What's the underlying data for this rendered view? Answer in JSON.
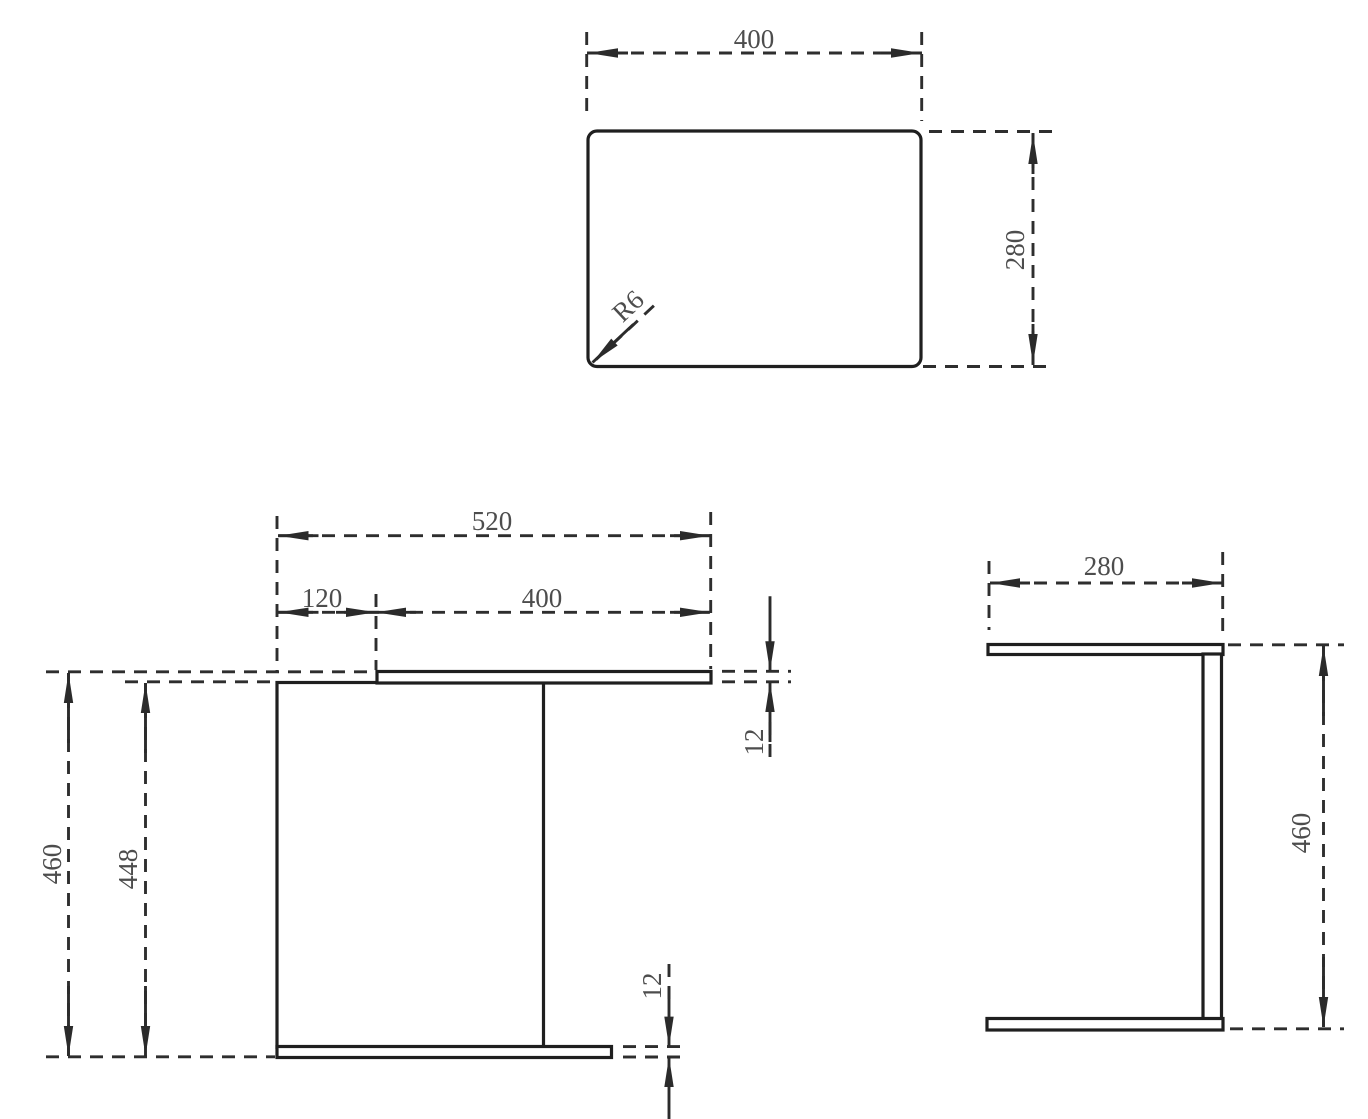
{
  "drawing": {
    "kind": "furniture-dimension-drawing",
    "canvas": {
      "width": 1368,
      "height": 1119,
      "background": "#ffffff"
    },
    "colors": {
      "outline": "#1f1f1f",
      "dash_line": "#2e2e2e",
      "arrow": "#2b2b2b",
      "label_text": "#4d4d4d"
    },
    "style": {
      "outline_width": 3.2,
      "dash_width": 2.9,
      "dash_pattern": "13 9",
      "font_size": 27,
      "arrow_length": 30,
      "arrow_half_width": 4.7,
      "default_tail": 10
    },
    "views": [
      {
        "name": "top-view",
        "primitives": [
          {
            "t": "rect",
            "n": "tabletop-outline",
            "x": 588,
            "y": 131,
            "w": 333,
            "h": 235.5,
            "r": 9
          },
          {
            "t": "line",
            "n": "width-ext-line-left",
            "x1": 586.7,
            "y1": 32,
            "x2": 586.7,
            "y2": 118,
            "dash": true
          },
          {
            "t": "line",
            "n": "width-ext-line-right",
            "x1": 921.7,
            "y1": 32,
            "x2": 921.7,
            "y2": 121,
            "dash": true
          },
          {
            "t": "line",
            "n": "width-dim-line",
            "x1": 587,
            "y1": 53,
            "x2": 922,
            "y2": 53,
            "dash": true
          },
          {
            "t": "arrow",
            "n": "width-arrow-left",
            "x": 588,
            "y": 53,
            "a": 180
          },
          {
            "t": "arrow",
            "n": "width-arrow-right",
            "x": 921,
            "y": 53,
            "a": 0
          },
          {
            "t": "text",
            "n": "width-label",
            "x": 754,
            "y": 39,
            "s": "400",
            "r": 0
          },
          {
            "t": "line",
            "n": "depth-ext-line-top",
            "x1": 929,
            "y1": 131.5,
            "x2": 1052,
            "y2": 131.5,
            "dash": true
          },
          {
            "t": "line",
            "n": "depth-ext-line-bottom",
            "x1": 923,
            "y1": 366.5,
            "x2": 1053,
            "y2": 366.5,
            "dash": true
          },
          {
            "t": "line",
            "n": "depth-dim-line",
            "x1": 1033,
            "y1": 133,
            "x2": 1033,
            "y2": 365,
            "dash": true
          },
          {
            "t": "arrow",
            "n": "depth-arrow-top",
            "x": 1033,
            "y": 134,
            "a": 270
          },
          {
            "t": "arrow",
            "n": "depth-arrow-bottom",
            "x": 1033,
            "y": 364,
            "a": 90
          },
          {
            "t": "text",
            "n": "depth-label",
            "x": 1015,
            "y": 250,
            "s": "280",
            "r": -90
          },
          {
            "t": "line",
            "n": "corner-radius-leader",
            "x1": 596,
            "y1": 359.5,
            "x2": 659,
            "y2": 301,
            "dash": true
          },
          {
            "t": "arrow",
            "n": "corner-radius-arrow",
            "x": 592.5,
            "y": 362.5,
            "a": 137,
            "tail": 26
          },
          {
            "t": "text",
            "n": "corner-radius-label",
            "x": 628,
            "y": 306,
            "s": "R6",
            "r": -43
          }
        ]
      },
      {
        "name": "front-view",
        "primitives": [
          {
            "t": "rect",
            "n": "side-panel-outline",
            "x": 277,
            "y": 682.5,
            "w": 266.5,
            "h": 365,
            "r": 0
          },
          {
            "t": "rect",
            "n": "top-plate-outline",
            "x": 377,
            "y": 671.5,
            "w": 334,
            "h": 11.5,
            "r": 0
          },
          {
            "t": "rect",
            "n": "bottom-plate-outline",
            "x": 277,
            "y": 1046.5,
            "w": 334.5,
            "h": 11,
            "r": 0
          },
          {
            "t": "line",
            "n": "total-width-ext-left",
            "x1": 277,
            "y1": 516,
            "x2": 277,
            "y2": 671,
            "dash": true
          },
          {
            "t": "line",
            "n": "total-width-ext-right",
            "x1": 710.7,
            "y1": 512,
            "x2": 710.7,
            "y2": 669,
            "dash": true
          },
          {
            "t": "line",
            "n": "total-width-dim-line",
            "x1": 278,
            "y1": 535.7,
            "x2": 710,
            "y2": 535.7,
            "dash": true
          },
          {
            "t": "arrow",
            "n": "total-width-arrow-left",
            "x": 278.5,
            "y": 535.7,
            "a": 180
          },
          {
            "t": "arrow",
            "n": "total-width-arrow-right",
            "x": 710,
            "y": 535.7,
            "a": 0
          },
          {
            "t": "text",
            "n": "total-width-label",
            "x": 492,
            "y": 521,
            "s": "520",
            "r": 0
          },
          {
            "t": "line",
            "n": "offset-ext-middle",
            "x1": 376,
            "y1": 594,
            "x2": 376,
            "y2": 670,
            "dash": true
          },
          {
            "t": "line",
            "n": "offset-topwidth-dim-line",
            "x1": 278,
            "y1": 612.3,
            "x2": 710,
            "y2": 612.3,
            "dash": true
          },
          {
            "t": "arrow",
            "n": "offset-arrow-left",
            "x": 278.5,
            "y": 612.3,
            "a": 180
          },
          {
            "t": "arrow",
            "n": "offset-arrow-right",
            "x": 376,
            "y": 612.3,
            "a": 0
          },
          {
            "t": "arrow",
            "n": "topwidth-arrow-left",
            "x": 376,
            "y": 612.3,
            "a": 180
          },
          {
            "t": "arrow",
            "n": "topwidth-arrow-right",
            "x": 710,
            "y": 612.3,
            "a": 0
          },
          {
            "t": "text",
            "n": "offset-label",
            "x": 322,
            "y": 598,
            "s": "120",
            "r": 0
          },
          {
            "t": "text",
            "n": "topwidth-label",
            "x": 542,
            "y": 598,
            "s": "400",
            "r": 0
          },
          {
            "t": "line",
            "n": "height-ext-top",
            "x1": 46,
            "y1": 671.8,
            "x2": 374,
            "y2": 671.8,
            "dash": true
          },
          {
            "t": "line",
            "n": "height-ext-bottom",
            "x1": 46,
            "y1": 1056.8,
            "x2": 275,
            "y2": 1056.8,
            "dash": true
          },
          {
            "t": "line",
            "n": "height-dim-line",
            "x1": 68.5,
            "y1": 673,
            "x2": 68.5,
            "y2": 1056,
            "dash": true
          },
          {
            "t": "arrow",
            "n": "height-arrow-top",
            "x": 68.5,
            "y": 673,
            "a": 270,
            "tail": 40
          },
          {
            "t": "arrow",
            "n": "height-arrow-bottom",
            "x": 68.5,
            "y": 1056,
            "a": 90,
            "tail": 40
          },
          {
            "t": "text",
            "n": "height-label",
            "x": 52,
            "y": 864,
            "s": "460",
            "r": -90
          },
          {
            "t": "line",
            "n": "inner-height-ext-top",
            "x1": 125,
            "y1": 681.8,
            "x2": 275,
            "y2": 681.8,
            "dash": true
          },
          {
            "t": "line",
            "n": "inner-height-dim-line",
            "x1": 145.5,
            "y1": 683,
            "x2": 145.5,
            "y2": 1056,
            "dash": true
          },
          {
            "t": "arrow",
            "n": "inner-height-arrow-top",
            "x": 145.5,
            "y": 683,
            "a": 270,
            "tail": 40
          },
          {
            "t": "arrow",
            "n": "inner-height-arrow-bottom",
            "x": 145.5,
            "y": 1056,
            "a": 90,
            "tail": 40
          },
          {
            "t": "text",
            "n": "inner-height-label",
            "x": 128,
            "y": 869,
            "s": "448",
            "r": -90
          },
          {
            "t": "line",
            "n": "top-thickness-ext-upper",
            "x1": 722,
            "y1": 671.3,
            "x2": 791,
            "y2": 671.3,
            "dash": true
          },
          {
            "t": "line",
            "n": "top-thickness-ext-lower",
            "x1": 722,
            "y1": 681.8,
            "x2": 791,
            "y2": 681.8,
            "dash": true
          },
          {
            "t": "arrow",
            "n": "top-thickness-arrow-down",
            "x": 770,
            "y": 671.3,
            "a": 90,
            "tail": 45
          },
          {
            "t": "arrow",
            "n": "top-thickness-arrow-up",
            "x": 770,
            "y": 682,
            "a": 270,
            "tail": 30
          },
          {
            "t": "line",
            "n": "top-thickness-leader",
            "x1": 770,
            "y1": 722,
            "x2": 770,
            "y2": 764,
            "dash": true
          },
          {
            "t": "text",
            "n": "top-thickness-label",
            "x": 754,
            "y": 742,
            "s": "12",
            "r": -90
          },
          {
            "t": "line",
            "n": "bottom-thickness-ext-upper",
            "x1": 623,
            "y1": 1046.6,
            "x2": 688,
            "y2": 1046.6,
            "dash": true
          },
          {
            "t": "line",
            "n": "bottom-thickness-ext-lower",
            "x1": 623,
            "y1": 1057,
            "x2": 688,
            "y2": 1057,
            "dash": true
          },
          {
            "t": "arrow",
            "n": "bottom-thickness-arrow-down",
            "x": 669,
            "y": 1046.6,
            "a": 90,
            "tail": 30
          },
          {
            "t": "line",
            "n": "bottom-thickness-leader",
            "x1": 669,
            "y1": 964,
            "x2": 669,
            "y2": 1004,
            "dash": true
          },
          {
            "t": "arrow",
            "n": "bottom-thickness-arrow-up",
            "x": 669,
            "y": 1057,
            "a": 270,
            "tail": 45
          },
          {
            "t": "text",
            "n": "bottom-thickness-label",
            "x": 652,
            "y": 986,
            "s": "12",
            "r": -90
          }
        ]
      },
      {
        "name": "side-view",
        "primitives": [
          {
            "t": "rect",
            "n": "top-plate-outline",
            "x": 988,
            "y": 644.5,
            "w": 235,
            "h": 10,
            "r": 0
          },
          {
            "t": "rect",
            "n": "back-panel-outline",
            "x": 1203,
            "y": 654,
            "w": 18.5,
            "h": 365,
            "r": 0
          },
          {
            "t": "rect",
            "n": "bottom-plate-outline",
            "x": 987,
            "y": 1018.5,
            "w": 236,
            "h": 11.5,
            "r": 0
          },
          {
            "t": "line",
            "n": "depth-ext-left",
            "x1": 989,
            "y1": 561,
            "x2": 989,
            "y2": 630,
            "dash": true
          },
          {
            "t": "line",
            "n": "depth-ext-right",
            "x1": 1222.7,
            "y1": 552,
            "x2": 1222.7,
            "y2": 638,
            "dash": true
          },
          {
            "t": "line",
            "n": "depth-dim-line",
            "x1": 990,
            "y1": 583,
            "x2": 1222,
            "y2": 583,
            "dash": true
          },
          {
            "t": "arrow",
            "n": "depth-arrow-left",
            "x": 990,
            "y": 583,
            "a": 180
          },
          {
            "t": "arrow",
            "n": "depth-arrow-right",
            "x": 1222,
            "y": 583,
            "a": 0
          },
          {
            "t": "text",
            "n": "depth-label",
            "x": 1104,
            "y": 566,
            "s": "280",
            "r": 0
          },
          {
            "t": "line",
            "n": "height-ext-top",
            "x1": 1228,
            "y1": 644.8,
            "x2": 1344,
            "y2": 644.8,
            "dash": true
          },
          {
            "t": "line",
            "n": "height-ext-bottom",
            "x1": 1230,
            "y1": 1028.8,
            "x2": 1344,
            "y2": 1028.8,
            "dash": true
          },
          {
            "t": "line",
            "n": "height-dim-line",
            "x1": 1323.5,
            "y1": 646,
            "x2": 1323.5,
            "y2": 1027,
            "dash": true
          },
          {
            "t": "arrow",
            "n": "height-arrow-top",
            "x": 1323.5,
            "y": 646,
            "a": 270,
            "tail": 40
          },
          {
            "t": "arrow",
            "n": "height-arrow-bottom",
            "x": 1323.5,
            "y": 1027,
            "a": 90,
            "tail": 40
          },
          {
            "t": "text",
            "n": "height-label",
            "x": 1301,
            "y": 833,
            "s": "460",
            "r": -90
          }
        ]
      }
    ]
  }
}
